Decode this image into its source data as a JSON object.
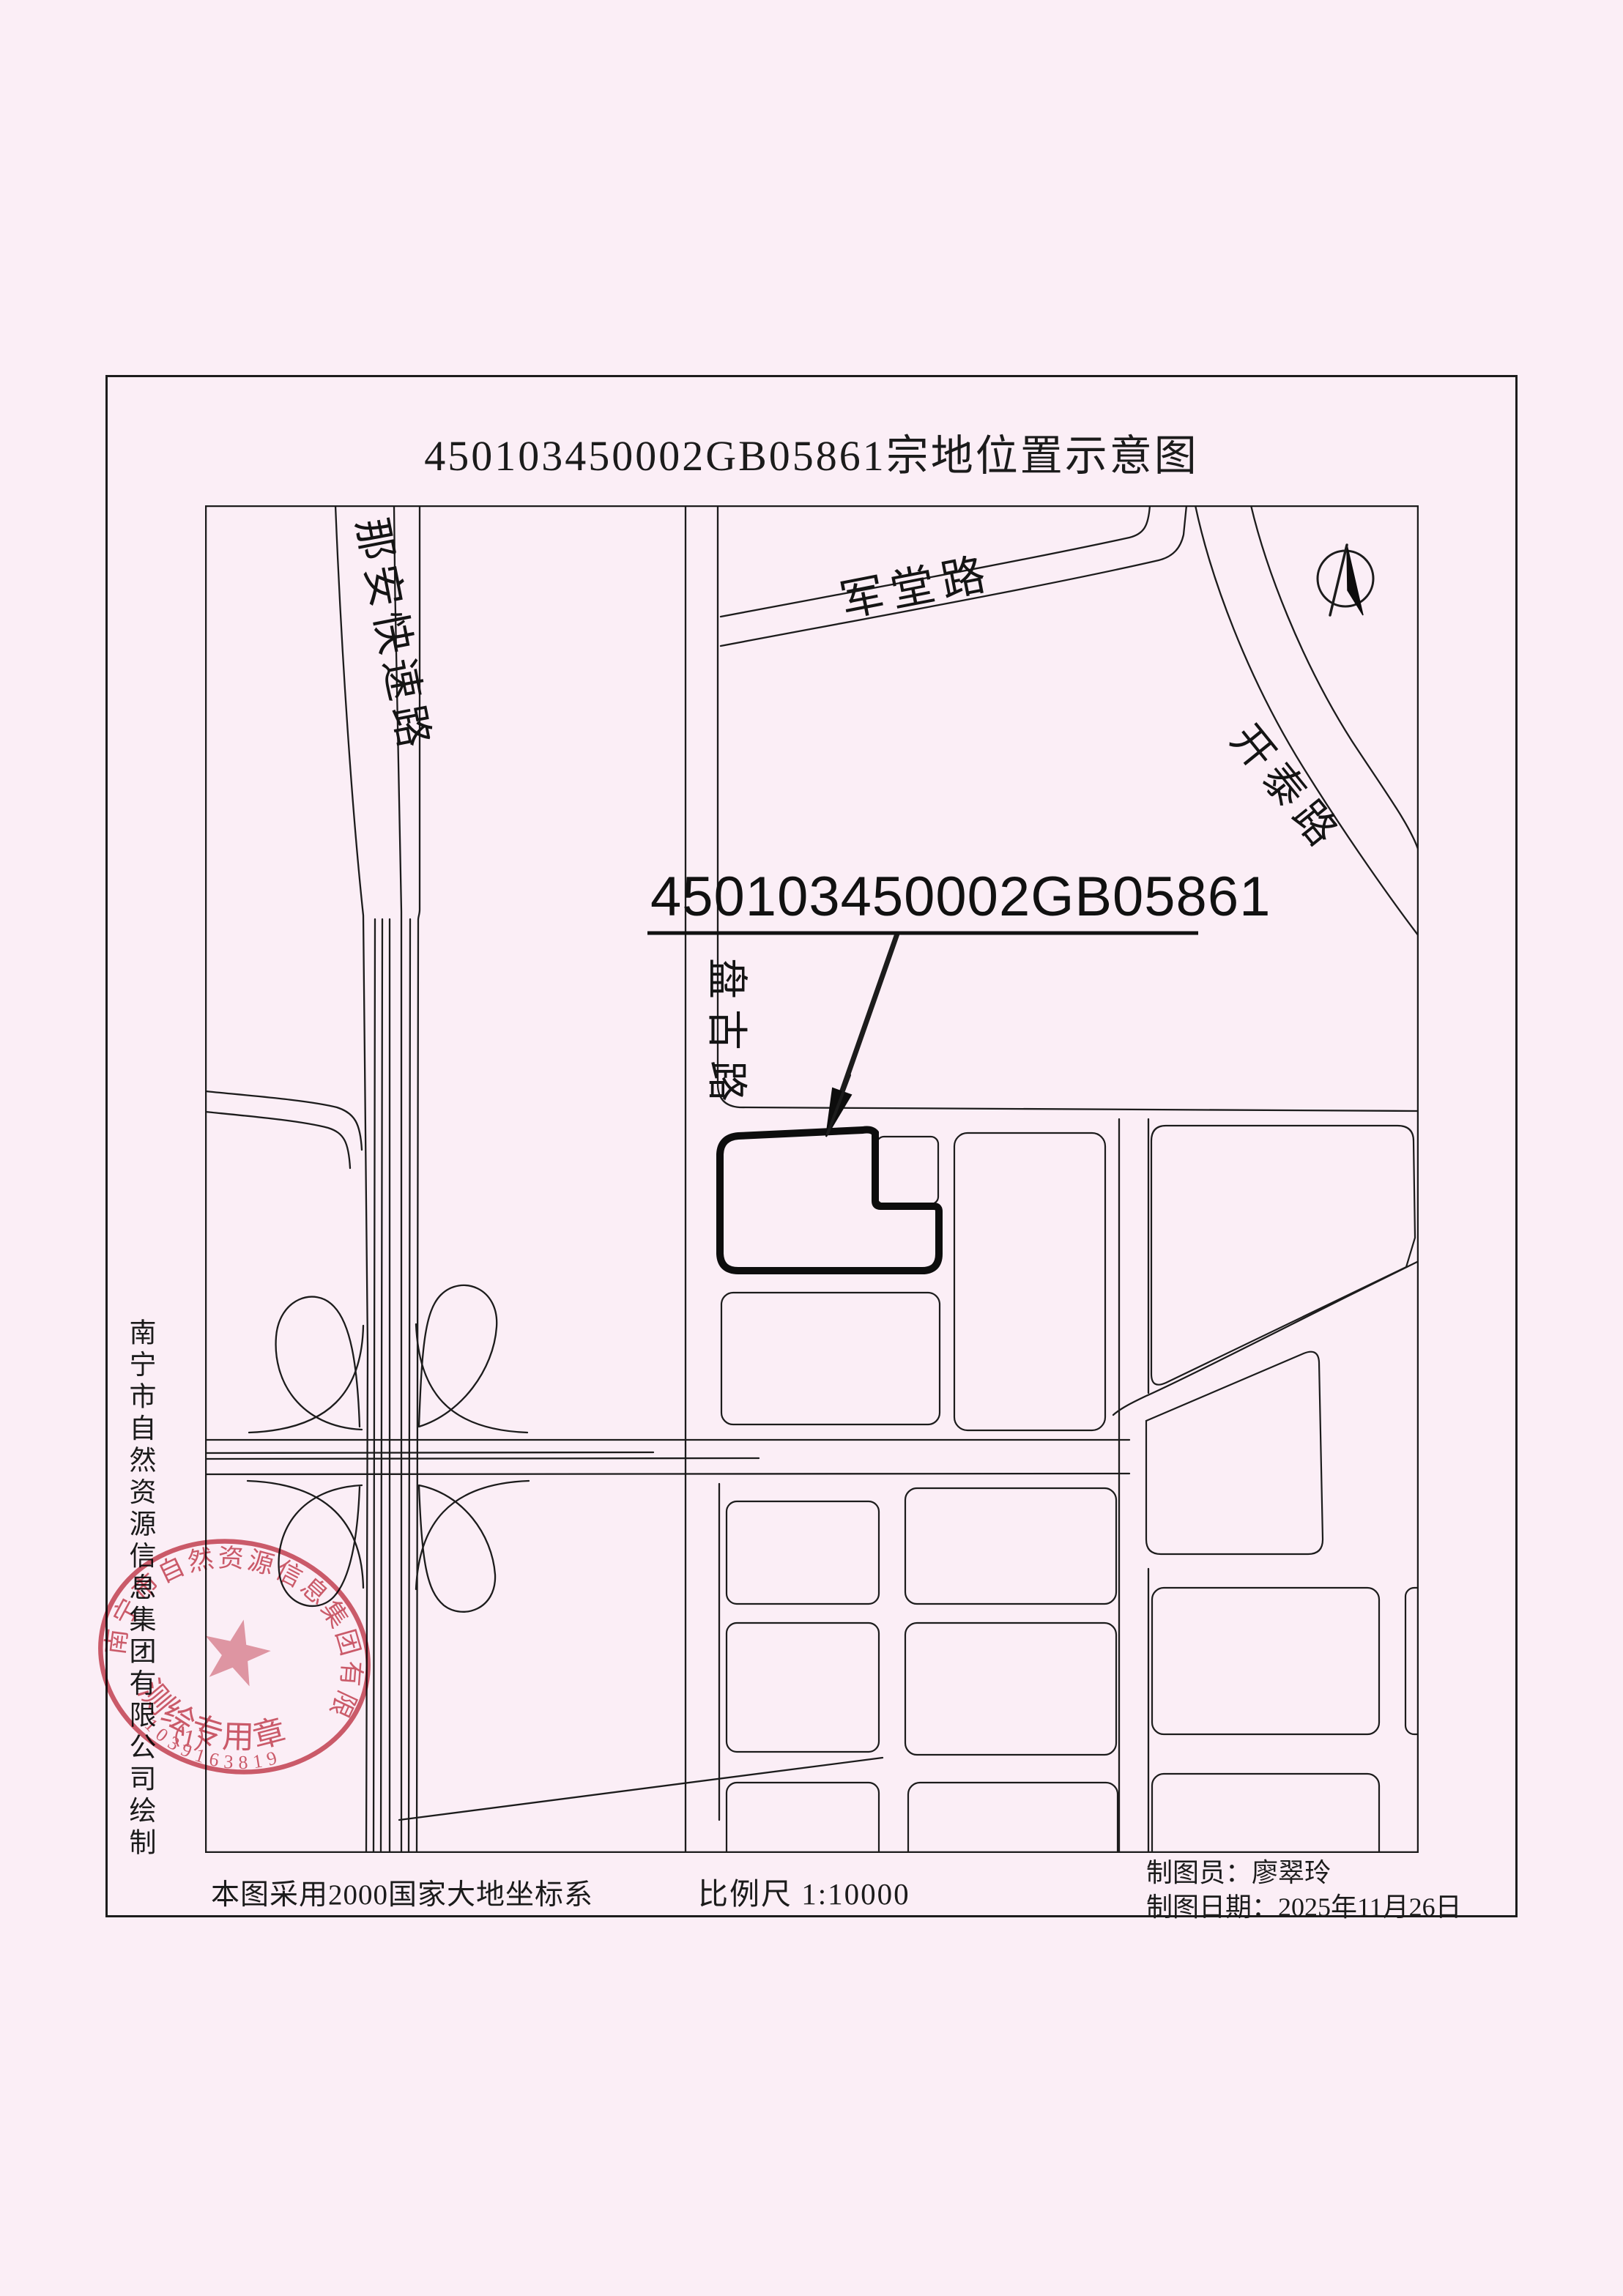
{
  "page": {
    "title": "450103450002GB05861宗地位置示意图",
    "paper_color": "#fbeef6",
    "line_color": "#1c1c1c"
  },
  "map": {
    "labels": {
      "expressway": "那安快速路",
      "road_top": "军堂路",
      "road_northeast": "开泰路",
      "road_center": "盘古路"
    },
    "parcel": {
      "id": "450103450002GB05861"
    },
    "compass": {
      "icon": "north-arrow"
    }
  },
  "attribution": {
    "vertical_text": "南宁市自然资源信息集团有限公司绘制"
  },
  "stamp": {
    "ring_text": "南宁市自然资源信息集团有限公司",
    "center_text": "测绘专用章",
    "paren_text": "（1）",
    "code": "1039163819",
    "color": "#c94f5d"
  },
  "footer": {
    "datum_note": "本图采用2000国家大地坐标系",
    "scale_label": "比例尺 1:10000",
    "cartographer_label": "制图员：",
    "cartographer_name": "廖翠玲",
    "date_label": "制图日期：",
    "date_value": "2025年11月26日"
  }
}
